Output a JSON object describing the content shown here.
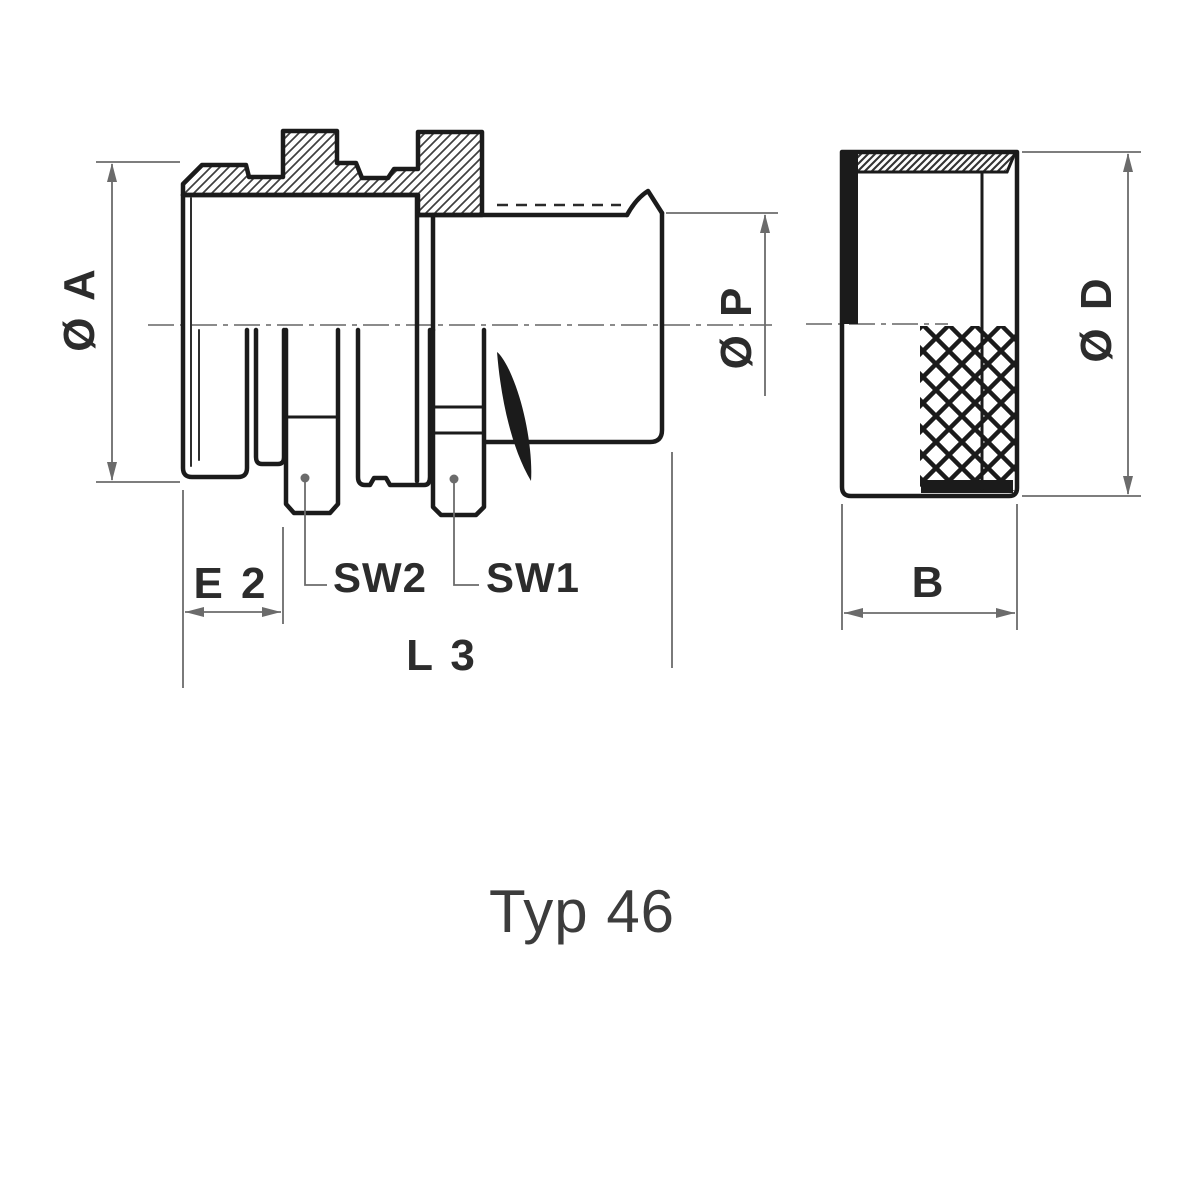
{
  "title_label": "Typ 46",
  "views": {
    "front_section": {
      "name": "connector-front-section-view",
      "dimension_labels": {
        "dia_a": "Ø A",
        "dia_p": "Ø P",
        "e2": "E 2",
        "sw2": "SW2",
        "sw1": "SW1",
        "l3": "L 3"
      }
    },
    "side_cap": {
      "name": "cap-side-view",
      "dimension_labels": {
        "dia_d": "Ø D",
        "b": "B"
      }
    }
  },
  "colors": {
    "background": "#ffffff",
    "outline": "#1b1b1b",
    "hatch": "#3f3f3f",
    "dimension_line": "#6b6b6b",
    "label_text": "#2c2c2c",
    "title_text": "#3c3c3c",
    "centerline": "#8b8b8b"
  }
}
